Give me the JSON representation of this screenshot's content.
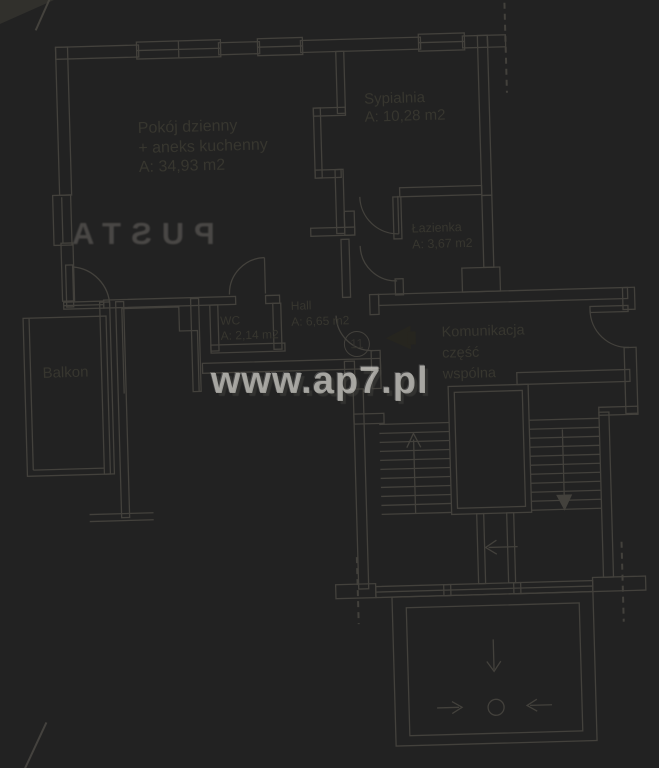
{
  "watermark": {
    "text": "www.ap7.pl"
  },
  "bleed_text": "PUSTA",
  "apartment": {
    "number": "11",
    "rooms": {
      "living": {
        "name_line1": "Pokój dzienny",
        "name_line2": "+ aneks kuchenny",
        "area": "A: 34,93 m2"
      },
      "bedroom": {
        "name": "Sypialnia",
        "area": "A: 10,28 m2"
      },
      "bathroom": {
        "name": "Łazienka",
        "area": "A: 3,67 m2"
      },
      "wc": {
        "name": "WC",
        "area": "A: 2,14 m2"
      },
      "hall": {
        "name": "Hall",
        "area": "A: 6,65 m2"
      },
      "balcony": {
        "name": "Balkon"
      }
    },
    "common_area": {
      "line1": "Komunikacja",
      "line2": "część",
      "line3": "wspólna"
    }
  },
  "colors": {
    "paper": "#b6b3ad",
    "line": "#43413c",
    "label_text": "#37362f",
    "entrance_arrow": "#26251f"
  }
}
